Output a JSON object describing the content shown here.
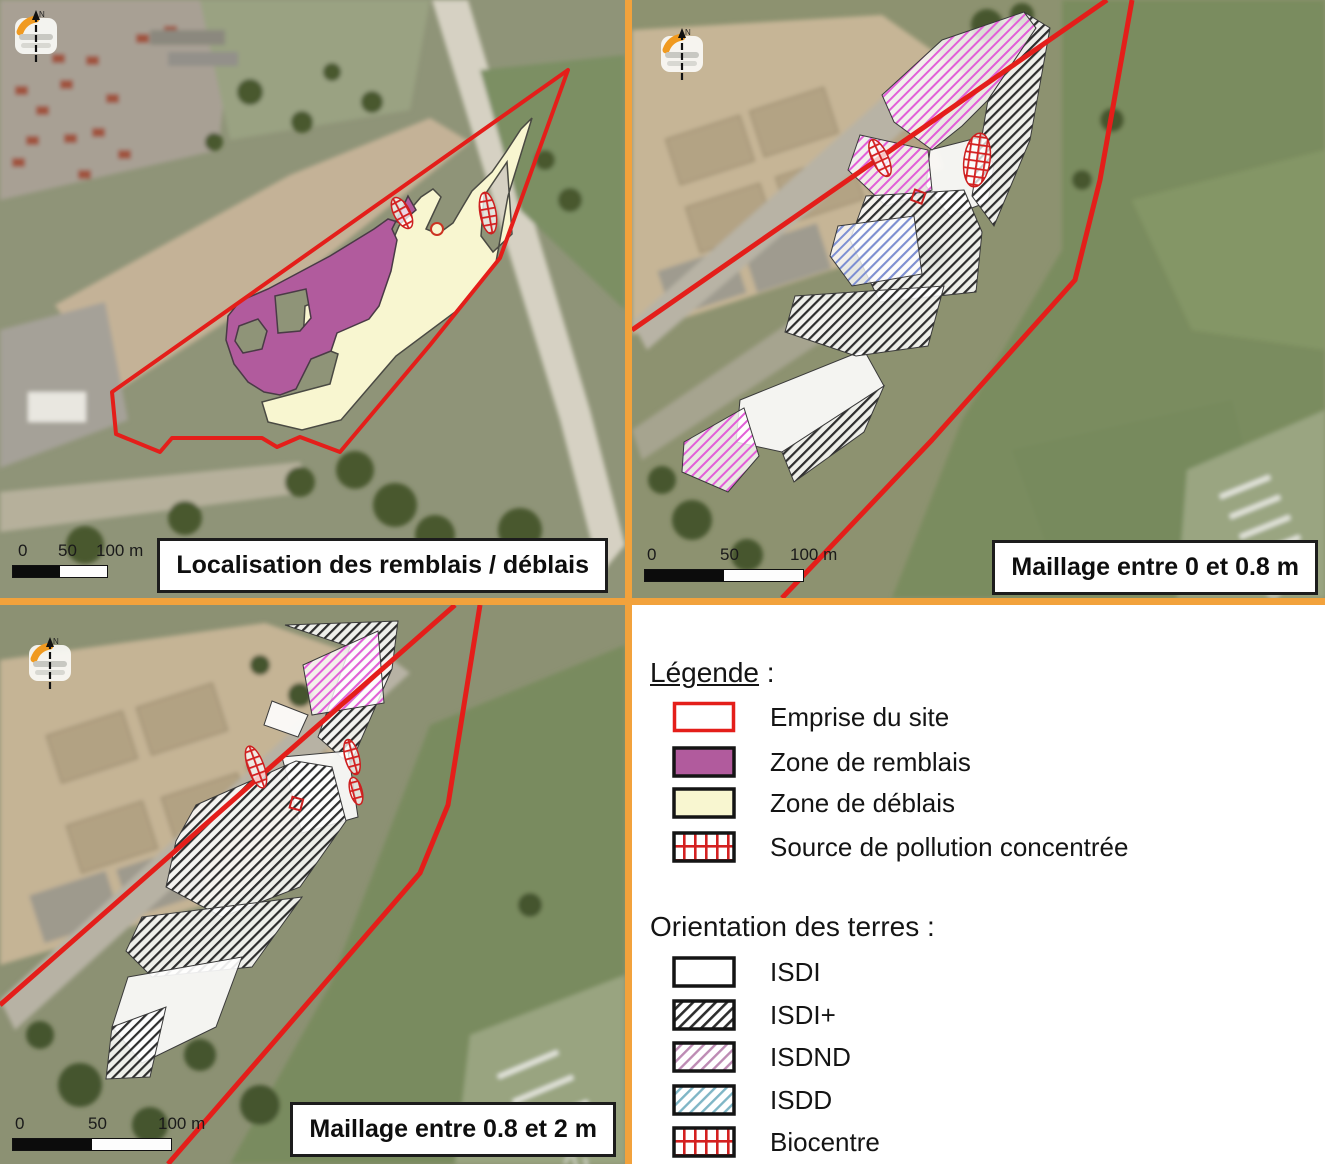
{
  "panels": {
    "top_left": {
      "title": "Localisation des remblais / déblais"
    },
    "top_right": {
      "title": "Maillage entre 0 et 0.8 m"
    },
    "bottom_left": {
      "title": "Maillage entre 0.8 et 2 m"
    }
  },
  "compass": {
    "label": "N"
  },
  "scale": {
    "zero": "0",
    "fifty": "50",
    "hundred": "100 m"
  },
  "aerial": {
    "runway_marking": "12"
  },
  "legend": {
    "title_word": "Légende",
    "title_colon": " :",
    "items": [
      {
        "label": "Emprise du site",
        "swatch": "site-outline-red"
      },
      {
        "label": "Zone de remblais",
        "swatch": "solid-purple"
      },
      {
        "label": "Zone de déblais",
        "swatch": "solid-pale-yellow"
      },
      {
        "label": "Source de pollution concentrée",
        "swatch": "red-grid"
      }
    ],
    "orientation_title": "Orientation des terres :",
    "orientation_items": [
      {
        "label": "ISDI",
        "swatch": "white"
      },
      {
        "label": "ISDI+",
        "swatch": "black-diagonal-hatch"
      },
      {
        "label": "ISDND",
        "swatch": "pink-diagonal-hatch"
      },
      {
        "label": "ISDD",
        "swatch": "blue-diagonal-hatch"
      },
      {
        "label": "Biocentre",
        "swatch": "red-grid"
      }
    ]
  },
  "colors": {
    "site_boundary": "#e41e1a",
    "zone_remblais": "#b15b9d",
    "zone_deblais": "#f8f6d0",
    "pollution_grid": "#d42020",
    "isdi_plus_hatch": "#2d2d2d",
    "isdnd_hatch_map": "#e25fd8",
    "isdnd_hatch_legend": "#bd8bb4",
    "isdd_hatch_map": "#7d8fd2",
    "isdd_hatch_legend": "#7fb6c6",
    "divider_orange": "#f2a23c"
  }
}
